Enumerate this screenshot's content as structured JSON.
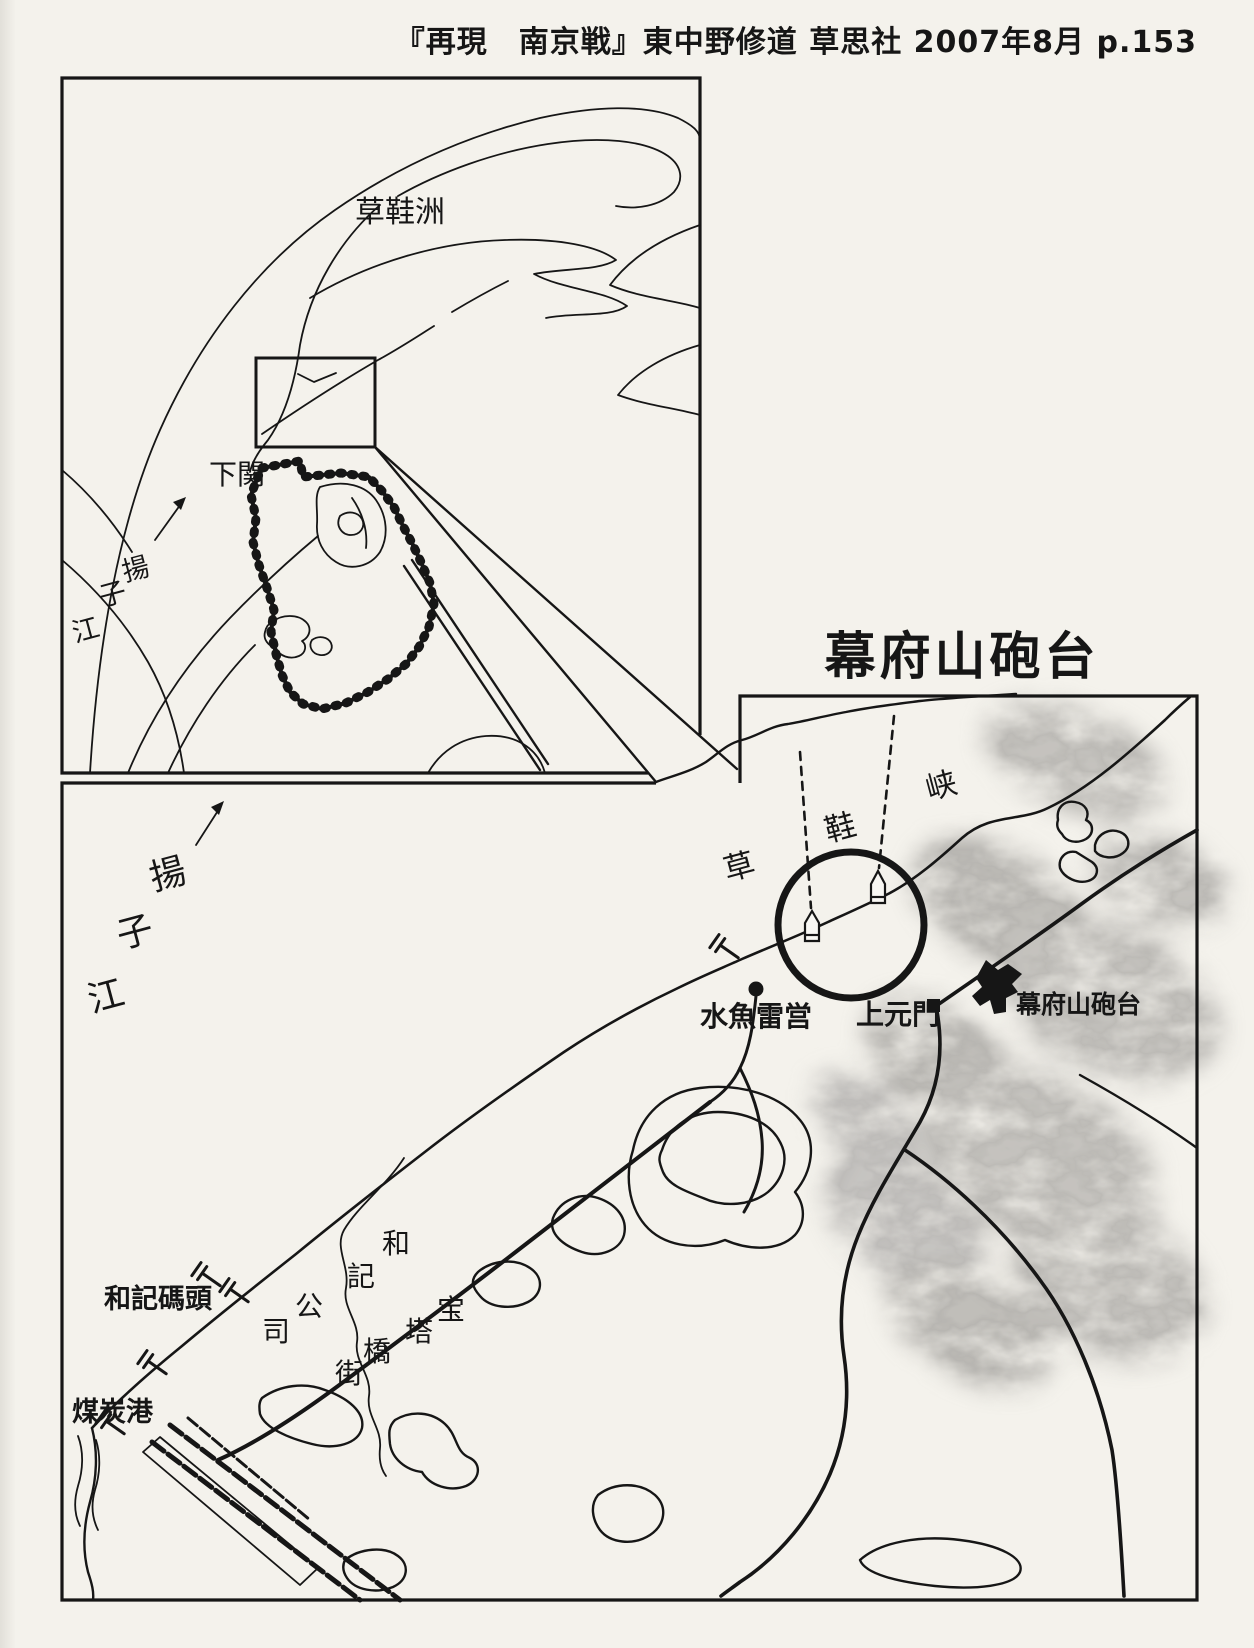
{
  "page": {
    "source_caption": "『再現　南京戦』東中野修道 草思社 2007年8月 p.153",
    "colors": {
      "paper": "#f4f2ec",
      "ink": "#161616",
      "mountain_shade": "#8f8d8a"
    }
  },
  "inset_map": {
    "island_label": "草鞋洲",
    "xiaguan_label": "下関",
    "yangtze_chars": [
      "揚",
      "子",
      "江"
    ]
  },
  "main_map": {
    "title": "幕府山砲台",
    "yangtze_chars": [
      "揚",
      "子",
      "江"
    ],
    "gorge_chars": [
      "草",
      "鞋",
      "峡"
    ],
    "torpedo_station_label": "水魚雷営",
    "shangyuanmen_label": "上元門",
    "battery_label": "幕府山砲台",
    "wharf_label": "和記碼頭",
    "coal_port_label": "煤炭港",
    "company_chars": [
      "和",
      "記",
      "公",
      "司"
    ],
    "street_chars": [
      "宝",
      "塔",
      "橋",
      "街"
    ]
  }
}
